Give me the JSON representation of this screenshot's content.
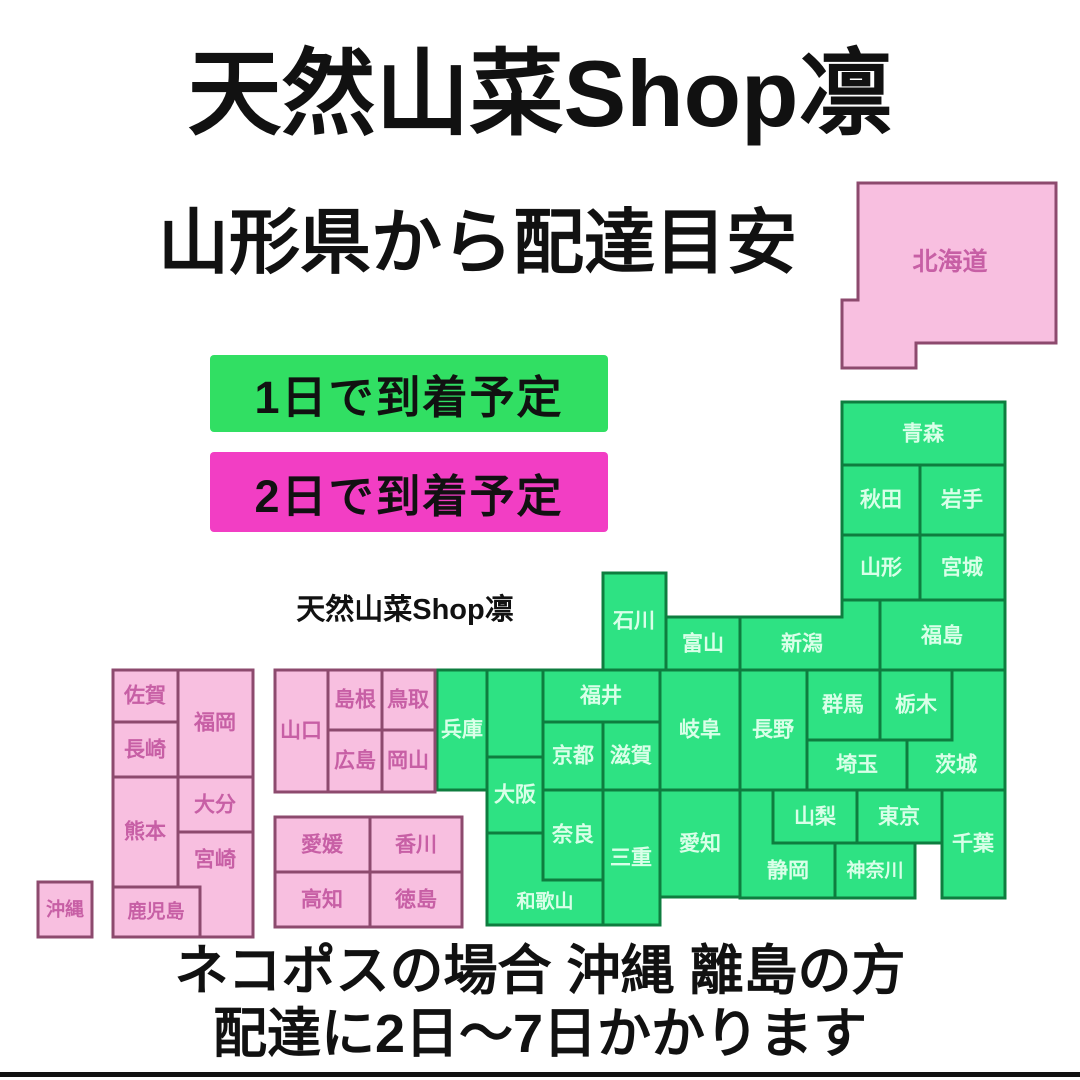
{
  "title": "天然山菜Shop凛",
  "subtitle": "山形県から配達目安",
  "watermark": "天然山菜Shop凛",
  "legend": {
    "one_day": "1日で到着予定",
    "two_day": "2日で到着予定"
  },
  "footer": {
    "line1": "ネコポスの場合 沖縄 離島の方",
    "line2": "配達に2日〜7日かかります"
  },
  "origin_prefecture": "山形県",
  "colors": {
    "background": "#ffffff",
    "ink": "#111111",
    "legend_one_day_bg": "#31df63",
    "legend_two_day_bg": "#f23ec4",
    "map_green_fill": "#2ee283",
    "map_green_border": "#0e7d3f",
    "map_green_text": "#d9ffe8",
    "map_pink_fill": "#f8bfe0",
    "map_pink_border": "#8d4a6e",
    "map_pink_text": "#c75fa5"
  },
  "map": {
    "prefectures": {
      "hokkaido": {
        "name": "北海道",
        "delivery_days": 2
      },
      "aomori": {
        "name": "青森",
        "delivery_days": 1
      },
      "akita": {
        "name": "秋田",
        "delivery_days": 1
      },
      "iwate": {
        "name": "岩手",
        "delivery_days": 1
      },
      "yamagata": {
        "name": "山形",
        "delivery_days": 1
      },
      "miyagi": {
        "name": "宮城",
        "delivery_days": 1
      },
      "fukushima": {
        "name": "福島",
        "delivery_days": 1
      },
      "niigata": {
        "name": "新潟",
        "delivery_days": 1
      },
      "ishikawa": {
        "name": "石川",
        "delivery_days": 1
      },
      "toyama": {
        "name": "富山",
        "delivery_days": 1
      },
      "fukui": {
        "name": "福井",
        "delivery_days": 1
      },
      "gifu": {
        "name": "岐阜",
        "delivery_days": 1
      },
      "nagano": {
        "name": "長野",
        "delivery_days": 1
      },
      "gunma": {
        "name": "群馬",
        "delivery_days": 1
      },
      "tochigi": {
        "name": "栃木",
        "delivery_days": 1
      },
      "ibaraki": {
        "name": "茨城",
        "delivery_days": 1
      },
      "saitama": {
        "name": "埼玉",
        "delivery_days": 1
      },
      "hyogo": {
        "name": "兵庫",
        "delivery_days": 1
      },
      "kyoto": {
        "name": "京都",
        "delivery_days": 1
      },
      "shiga": {
        "name": "滋賀",
        "delivery_days": 1
      },
      "osaka": {
        "name": "大阪",
        "delivery_days": 1
      },
      "nara": {
        "name": "奈良",
        "delivery_days": 1
      },
      "mie": {
        "name": "三重",
        "delivery_days": 1
      },
      "wakayama": {
        "name": "和歌山",
        "delivery_days": 1
      },
      "aichi": {
        "name": "愛知",
        "delivery_days": 1
      },
      "yamanashi": {
        "name": "山梨",
        "delivery_days": 1
      },
      "tokyo": {
        "name": "東京",
        "delivery_days": 1
      },
      "shizuoka": {
        "name": "静岡",
        "delivery_days": 1
      },
      "kanagawa": {
        "name": "神奈川",
        "delivery_days": 1
      },
      "chiba": {
        "name": "千葉",
        "delivery_days": 1
      },
      "yamaguchi": {
        "name": "山口",
        "delivery_days": 2
      },
      "shimane": {
        "name": "島根",
        "delivery_days": 2
      },
      "tottori": {
        "name": "鳥取",
        "delivery_days": 2
      },
      "hiroshima": {
        "name": "広島",
        "delivery_days": 2
      },
      "okayama": {
        "name": "岡山",
        "delivery_days": 2
      },
      "ehime": {
        "name": "愛媛",
        "delivery_days": 2
      },
      "kagawa": {
        "name": "香川",
        "delivery_days": 2
      },
      "kochi": {
        "name": "高知",
        "delivery_days": 2
      },
      "tokushima": {
        "name": "徳島",
        "delivery_days": 2
      },
      "saga": {
        "name": "佐賀",
        "delivery_days": 2
      },
      "fukuoka": {
        "name": "福岡",
        "delivery_days": 2
      },
      "nagasaki": {
        "name": "長崎",
        "delivery_days": 2
      },
      "kumamoto": {
        "name": "熊本",
        "delivery_days": 2
      },
      "oita": {
        "name": "大分",
        "delivery_days": 2
      },
      "miyazaki": {
        "name": "宮崎",
        "delivery_days": 2
      },
      "kagoshima": {
        "name": "鹿児島",
        "delivery_days": 2
      },
      "okinawa": {
        "name": "沖縄",
        "delivery_days": 2
      }
    }
  }
}
